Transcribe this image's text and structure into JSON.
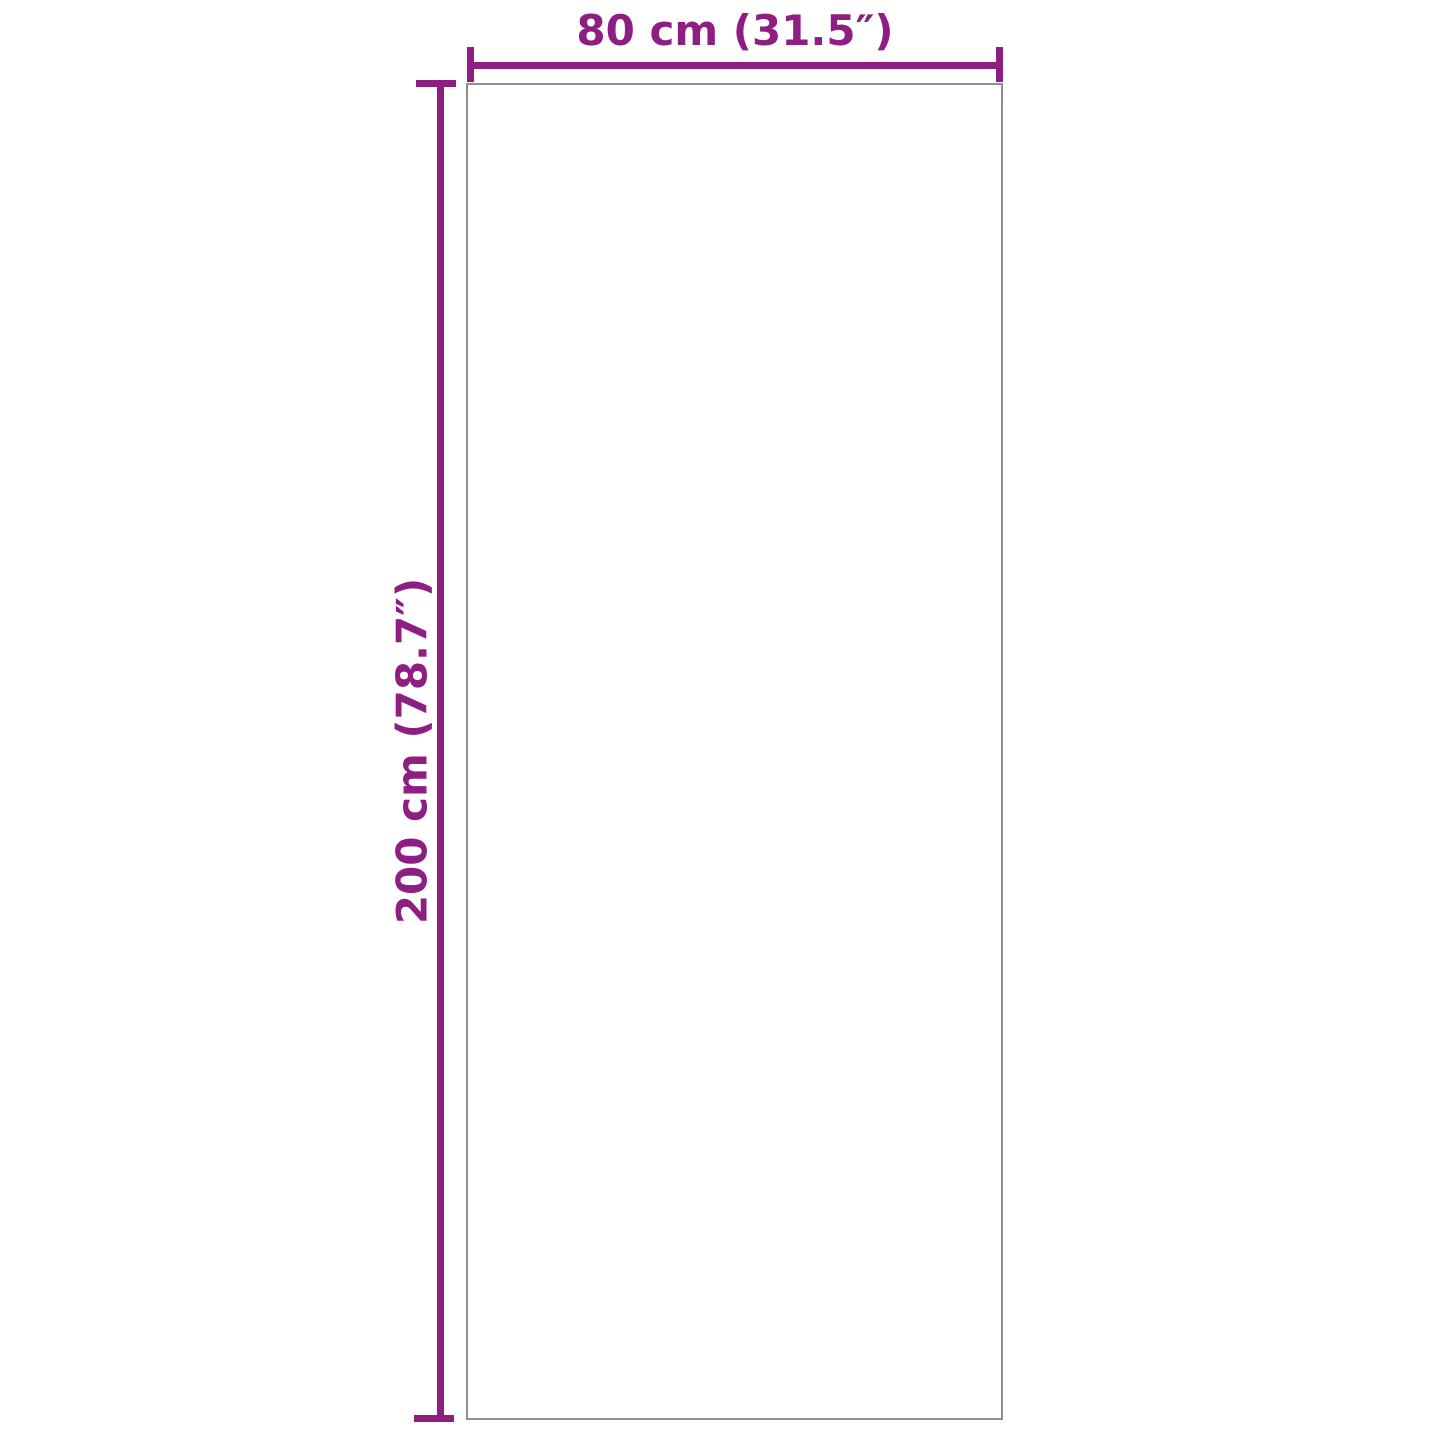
{
  "diagram": {
    "type": "product-dimension-diagram",
    "width_dimension": {
      "label": "80 cm (31.5″)",
      "value_cm": 80,
      "value_inch": 31.5
    },
    "height_dimension": {
      "label": "200 cm (78.7″)",
      "value_cm": 200,
      "value_inch": 78.7
    }
  },
  "colors": {
    "accent": "#8e1e82",
    "outline": "#8f8f8f",
    "background": "#ffffff"
  }
}
